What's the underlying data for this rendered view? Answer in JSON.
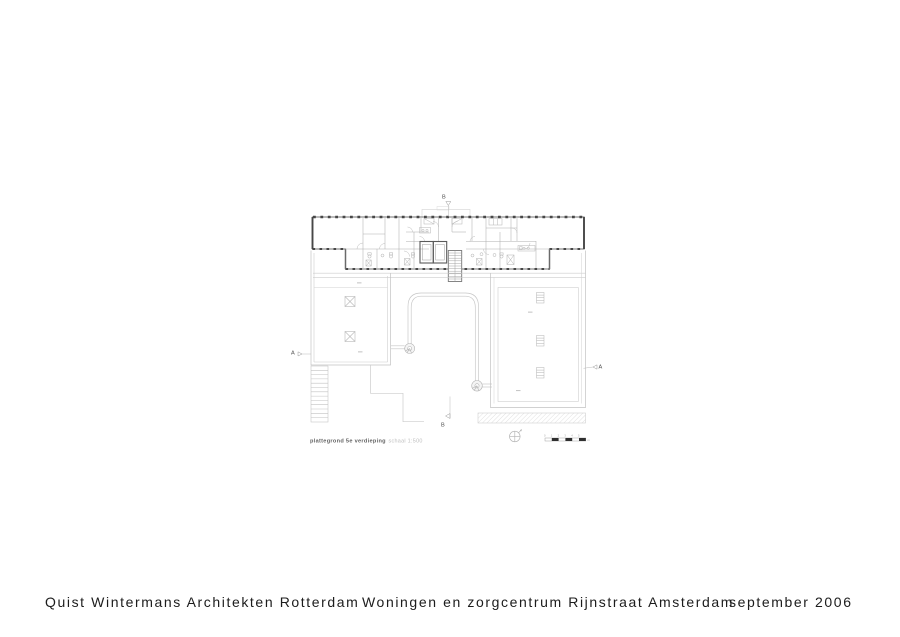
{
  "footer": {
    "firm": "Quist Wintermans Architekten Rotterdam",
    "project": "Woningen en zorgcentrum Rijnstraat Amsterdam",
    "date": "september 2006"
  },
  "drawing": {
    "title": "plattegrond 5e verdieping",
    "scale_label": "schaal 1:500",
    "section_markers": {
      "a_left": "A",
      "a_right": "A",
      "b_top": "B",
      "b_bottom": "B"
    },
    "scale_bar": {
      "tick_labels": [
        "0",
        "1",
        "2",
        "3",
        "4",
        "5"
      ],
      "unit": "m"
    },
    "colors": {
      "wall_dark": "#474747",
      "wall_medium": "#8a8a8a",
      "line_light": "#c6c6c6",
      "hatch": "#d6d6d6",
      "footer_text": "#1c1c1c",
      "title_text": "#626262",
      "scale_text": "#bdbdbd"
    }
  }
}
